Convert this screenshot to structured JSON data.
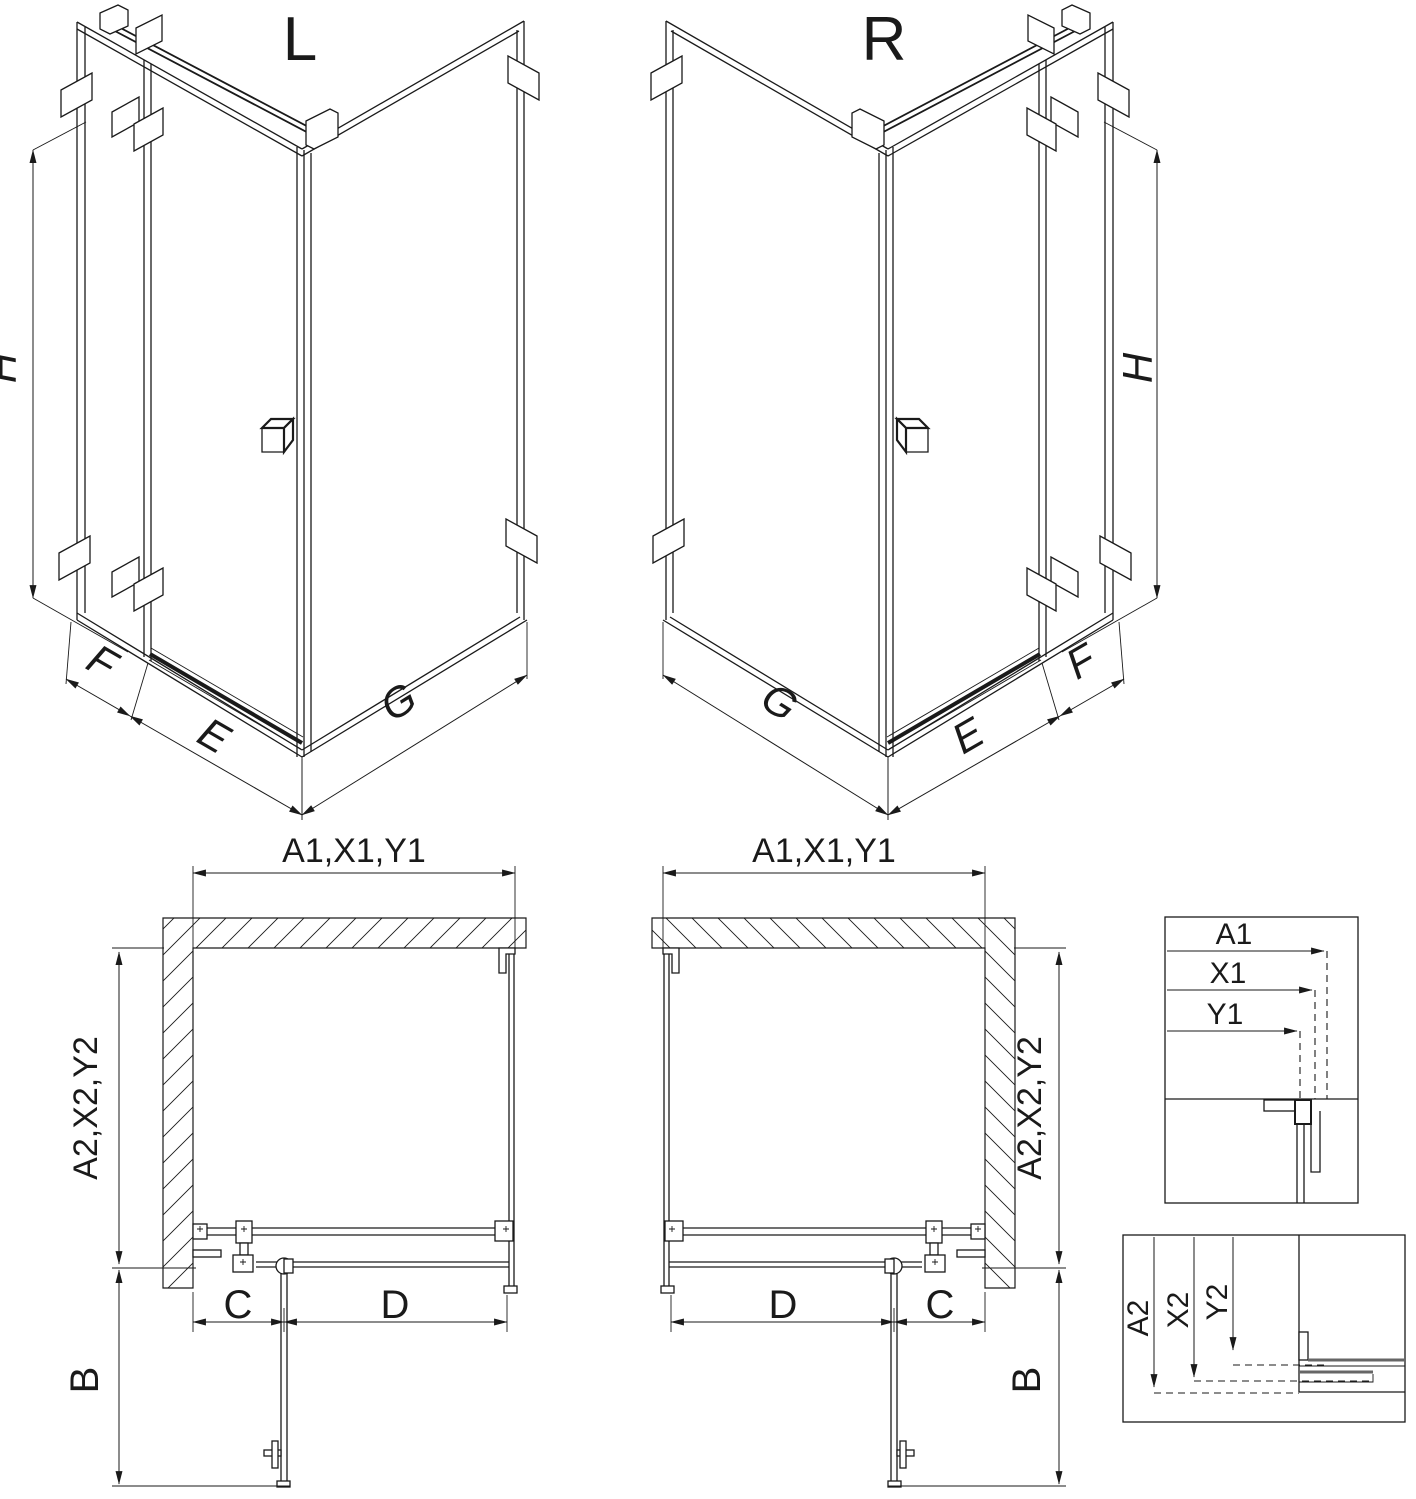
{
  "page": {
    "background": "#ffffff",
    "line_color": "#1a1a1a"
  },
  "iso_views": {
    "left": {
      "variant_label": "L",
      "height_dim": "H",
      "side_panel_dim": "F",
      "door_dim": "E",
      "return_panel_dim": "G"
    },
    "right": {
      "variant_label": "R",
      "height_dim": "H",
      "side_panel_dim": "F",
      "door_dim": "E",
      "return_panel_dim": "G"
    }
  },
  "plan_views": {
    "left": {
      "top_dim": "A1,X1,Y1",
      "side_dim": "A2,X2,Y2",
      "fixed_panel_dim": "C",
      "door_width_dim": "D",
      "door_open_dim": "B"
    },
    "right": {
      "top_dim": "A1,X1,Y1",
      "side_dim": "A2,X2,Y2",
      "fixed_panel_dim": "C",
      "door_width_dim": "D",
      "door_open_dim": "B"
    }
  },
  "detail_views": {
    "width_reference": {
      "dims": [
        "A1",
        "X1",
        "Y1"
      ]
    },
    "depth_reference": {
      "dims": [
        "A2",
        "X2",
        "Y2"
      ]
    }
  }
}
